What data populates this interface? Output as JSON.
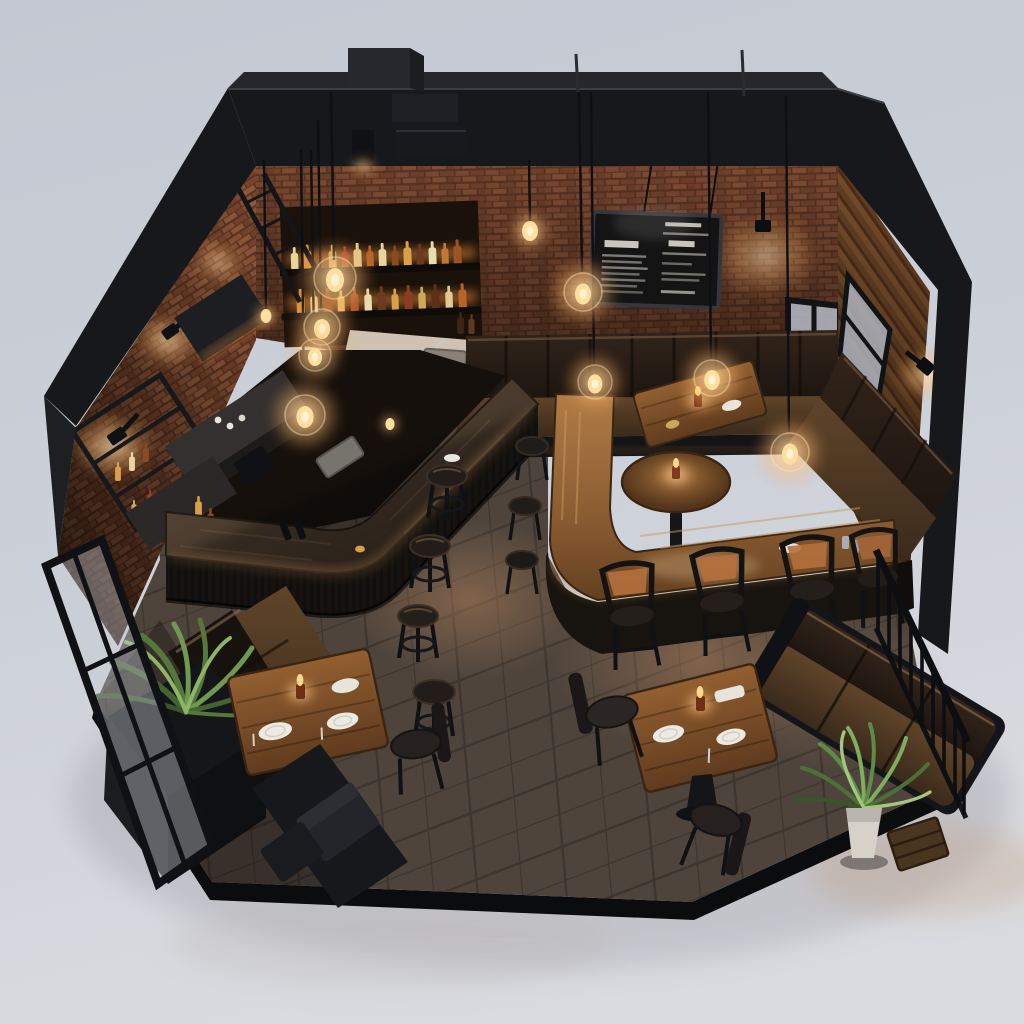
{
  "scene": {
    "subject": "Isometric cutaway 3D render of an industrial loft bar and restaurant interior",
    "style": "photorealistic architectural visualization, dark charcoal steel shell, exposed red brick, warm Edison-bulb lighting",
    "mood": "dim evening tungsten glow",
    "background_color": "#c9cdd6"
  },
  "architecture": {
    "shell": {
      "label": "black steel cutaway frame and roof fascia",
      "color": "#1a1b1e"
    },
    "walls": [
      {
        "label": "back brick wall",
        "color": "#7c4830"
      },
      {
        "label": "left brick wall",
        "color": "#8a5136"
      },
      {
        "label": "right wood-slat wall with black framed windows",
        "color": "#5e3b22"
      }
    ],
    "floor": {
      "label": "dark porcelain tile floor",
      "color": "#4e443c"
    },
    "ground": {
      "label": "light studio backdrop",
      "color": "#d2d5db"
    }
  },
  "fixtures": {
    "menu_board": {
      "label": "framed chalkboard menu, illegible handwritten items",
      "columns": 2,
      "board_color": "#141415",
      "frame_color": "#2e2f33"
    },
    "back_bar": {
      "label": "backlit liquor shelving",
      "shelves": 2,
      "bottles_approx": 27
    },
    "main_bar": {
      "label": "L-shaped charcoal wood bar counter",
      "stools": 4,
      "stool_type": "round backless"
    },
    "drink_counter": {
      "label": "L-shaped walnut high counter",
      "high_chairs": 4,
      "stools": 3
    },
    "banquette": {
      "label": "dark leather corner banquette",
      "tables": [
        "two-top wood table with candle",
        "round pedestal table with candle"
      ]
    },
    "dining_nook_left": {
      "label": "booth dining nook",
      "place_settings": 3,
      "candles": 1,
      "chairs": 1,
      "planter": "black box planter with tropical plant",
      "door": "open black-framed glass door"
    },
    "dining_corner_right": {
      "label": "open dining corner",
      "place_settings": 2,
      "candles": 1,
      "chairs": 2,
      "sofa": "tan leather settee",
      "planter": "white pot with palm",
      "railing": "black metal guardrail"
    }
  },
  "lighting": {
    "glass_globe_pendants": 9,
    "bare_bulb_pendants": 2,
    "wall_sconces": 4,
    "table_candles": 4,
    "glow_color": "#ffc37a"
  },
  "palette": {
    "shell_black": "#1a1b1e",
    "brick": "#82492f",
    "bar_top": "#4a3b2e",
    "counter_wood": "#9a6b3e",
    "leather_seat": "#4e3827",
    "leather_dark": "#241d17",
    "floor_tile": "#4e443c",
    "plant_green": "#6f9850",
    "glow_warm": "#ffc37a",
    "backdrop": "#d2d5db"
  }
}
